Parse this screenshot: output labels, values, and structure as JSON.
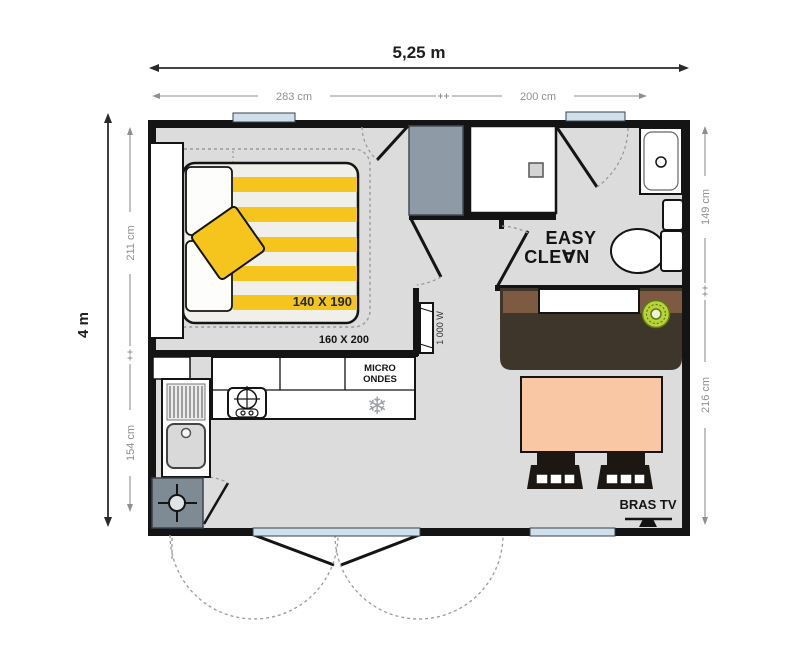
{
  "plan": {
    "dimensions": {
      "total_width": "5,25 m",
      "total_height": "4 m",
      "top_segments": [
        "283 cm",
        "200 cm"
      ],
      "left_segments": [
        "211 cm",
        "154 cm"
      ],
      "right_segments": [
        "149 cm",
        "216 cm"
      ]
    },
    "labels": {
      "bed_size": "140 X 190",
      "bed_size_alt": "160 X 200",
      "heater_power": "1 000 W",
      "microwave": [
        "MICRO",
        "ONDES"
      ],
      "logo": [
        "EASY",
        "CLE∀N"
      ],
      "tv_bracket": "BRAS TV"
    },
    "icons": {
      "freezer_snowflake": "❄"
    },
    "colors": {
      "wall_black": "#141414",
      "floor_gray": "#dcdcdc",
      "accent_yellow": "#f6c51d",
      "window_blue": "#cfe0ec",
      "wardrobe_slate": "#8e9ba6",
      "tech_slate": "#7e8b94",
      "bench_brown_dark": "#3f362b",
      "bench_brown_light": "#7d5a41",
      "table_salmon": "#f9c7a4",
      "stool_green": "#b9d437",
      "dim_gray": "#8f8f8f"
    }
  }
}
